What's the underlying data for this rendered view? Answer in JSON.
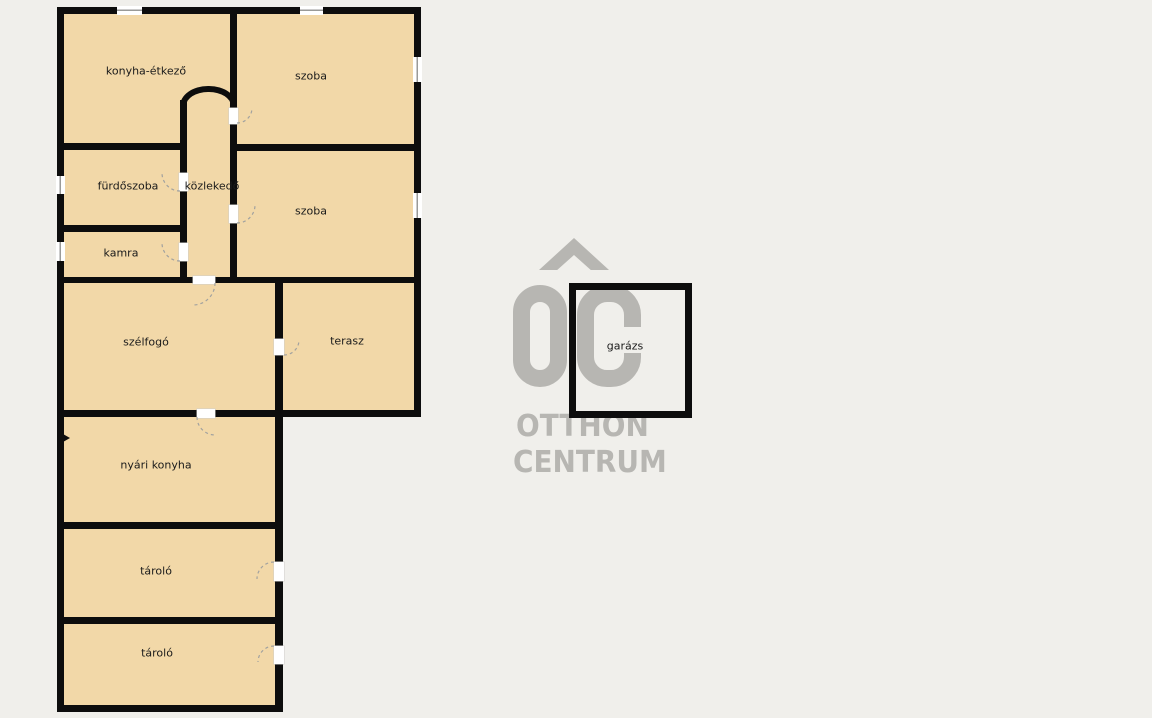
{
  "rooms": [
    {
      "id": "konyha-etkezo",
      "label": "konyha-étkező"
    },
    {
      "id": "szoba-felso",
      "label": "szoba"
    },
    {
      "id": "furdoszoba",
      "label": "fürdőszoba"
    },
    {
      "id": "kozlekedo",
      "label": "közlekedő"
    },
    {
      "id": "kamra",
      "label": "kamra"
    },
    {
      "id": "szoba-also",
      "label": "szoba"
    },
    {
      "id": "szelfogo",
      "label": "szélfogó"
    },
    {
      "id": "terasz",
      "label": "terasz"
    },
    {
      "id": "nyari-konyha",
      "label": "nyári konyha"
    },
    {
      "id": "tarolo-1",
      "label": "tároló"
    },
    {
      "id": "tarolo-2",
      "label": "tároló"
    },
    {
      "id": "garazs",
      "label": "garázs"
    }
  ],
  "watermark": {
    "monogram": "OC",
    "line1": "OTTHON",
    "line2": "CENTRUM"
  },
  "colors": {
    "background": "#f0efeb",
    "room_fill": "#f2d8a8",
    "wall": "#0d0d0d",
    "watermark": "#b7b6b2",
    "label_text": "#1b1b1b"
  }
}
